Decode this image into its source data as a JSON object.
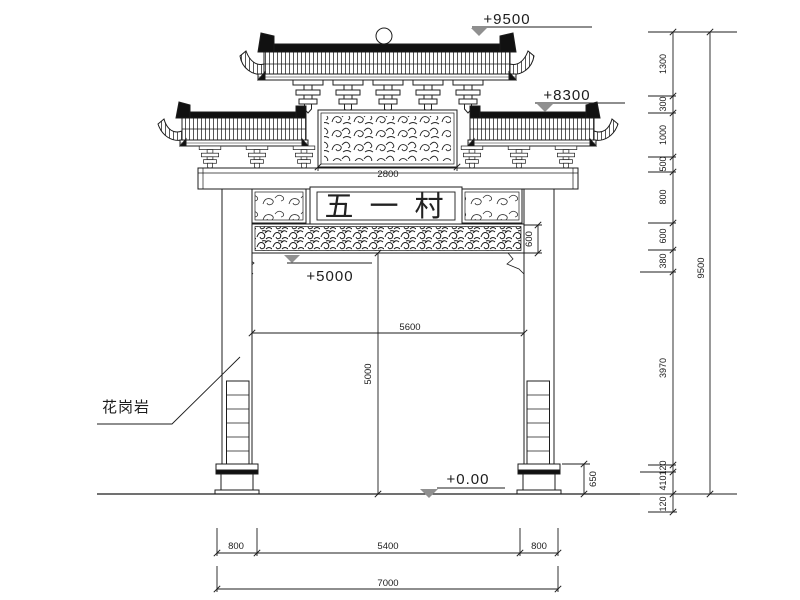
{
  "plaque": {
    "text": "五一村"
  },
  "labels": {
    "material": "花岗岩"
  },
  "levels": {
    "top": "+9500",
    "second_roof": "+8300",
    "plaque_band": "+5000",
    "ground": "+0.00"
  },
  "dims": {
    "panel_width": "2800",
    "frieze_height": "600",
    "opening_width": "5600",
    "opening_height": "5000",
    "pedestal_height": "650",
    "total_height": "9500",
    "chain": [
      "1300",
      "300",
      "1000",
      "500",
      "800",
      "600",
      "380",
      "3970",
      "120",
      "410",
      "120"
    ],
    "bottom_row1": [
      "800",
      "5400",
      "800"
    ],
    "bottom_total": "7000"
  }
}
